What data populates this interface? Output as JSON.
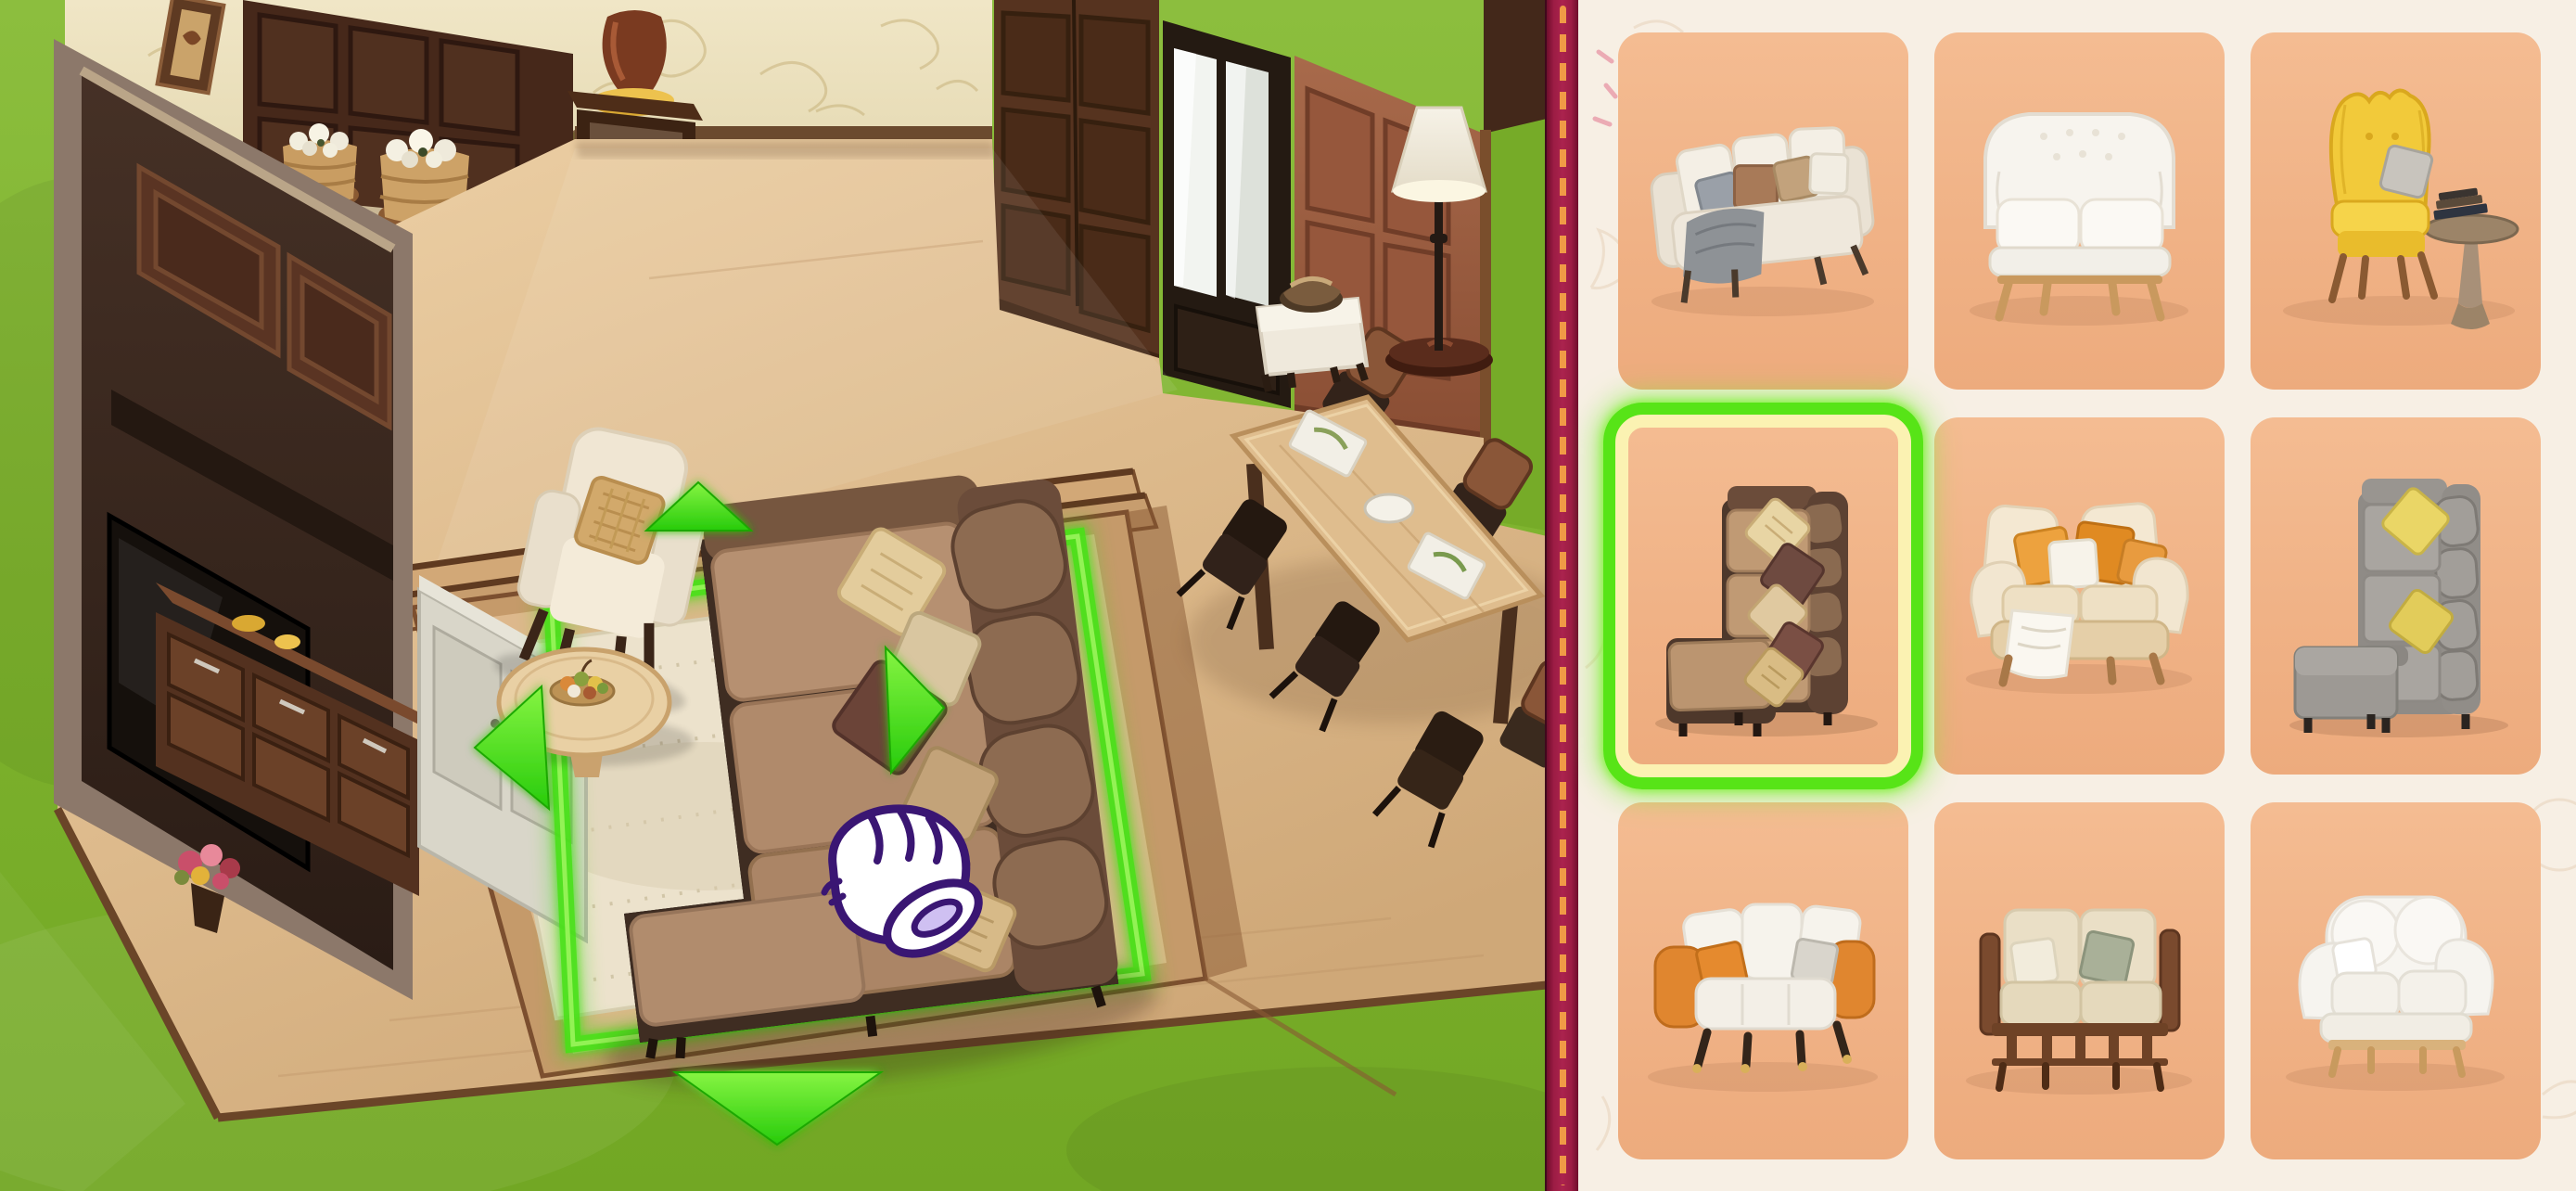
{
  "app": {
    "title": "Home Design Game — Furniture Placement Screen"
  },
  "room_scene": {
    "cursor": {
      "name": "glove-hand-cursor"
    },
    "selection": {
      "target": "Brown L-shaped sectional sofa",
      "arrows": [
        "up",
        "left",
        "right",
        "down"
      ],
      "highlight_color": "#46e214"
    },
    "furniture": [
      "TV media wall",
      "Dark wardrobe cabinet",
      "Storage bench with flower baskets",
      "Pedestal table with vase",
      "Brown double doors",
      "Mirror door",
      "Copper panel wall",
      "Dining table with chairs",
      "Floor lamp",
      "White ottoman with bronze bowl",
      "Cream armchair with gold pillow",
      "Round coffee table with fruit bowl",
      "Brown sectional sofa",
      "Cream area rug"
    ]
  },
  "furniture_panel": {
    "selected_index": 3,
    "background_color": "#f7efe4",
    "tile_color": "#f2b78c",
    "highlight_color": "#57e417",
    "items": [
      {
        "id": "sofa-cream-3seat",
        "label": "Cream three-seat sofa with gray throw"
      },
      {
        "id": "loveseat-white-tufted",
        "label": "White tufted loveseat with wood frame"
      },
      {
        "id": "armchair-yellow-wingback",
        "label": "Yellow wingback armchair with side table"
      },
      {
        "id": "sectional-brown",
        "label": "Brown L-shaped sectional sofa",
        "selected": true
      },
      {
        "id": "sofa-cream-orange",
        "label": "Cream sofa with orange pillows"
      },
      {
        "id": "sectional-gray",
        "label": "Gray L-shaped sectional sofa"
      },
      {
        "id": "sofa-white-orange",
        "label": "White sofa with orange arms"
      },
      {
        "id": "sofa-beige-woodframe",
        "label": "Beige sofa with wooden frame"
      },
      {
        "id": "loveseat-white-round",
        "label": "White rounded loveseat"
      }
    ]
  },
  "divider": {
    "color": "#9c1c44",
    "stitch_color": "#f09a46"
  },
  "colors": {
    "grass": "#7db22d",
    "floor": "#e2c094",
    "dark_wood": "#3e2b22",
    "wallpaper": "#ece1bd",
    "rug": "#ece2cc",
    "copper_wall": "#9a5f41"
  }
}
